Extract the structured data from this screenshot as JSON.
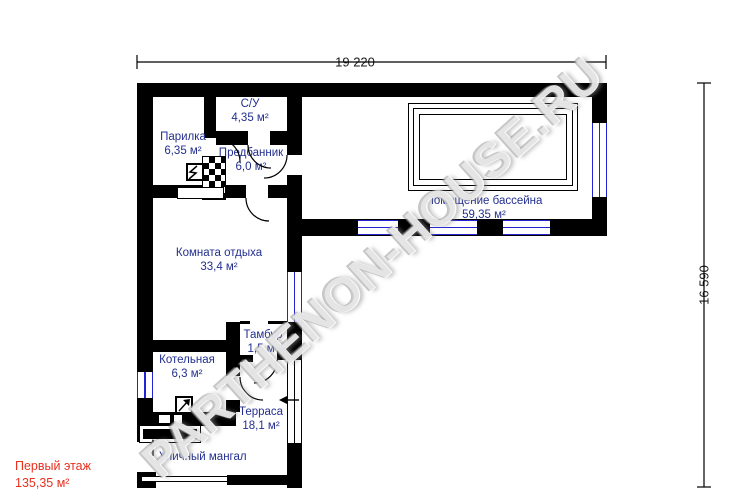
{
  "watermark": "PARTHENON-HOUSE.RU",
  "dimensions": {
    "width": "19 220",
    "height": "16 590"
  },
  "rooms": {
    "parilka": {
      "name": "Парилка",
      "area": "6,35 м²"
    },
    "su": {
      "name": "С/У",
      "area": "4,35 м²"
    },
    "predbannik": {
      "name": "Предбанник",
      "area": "6,0 м²"
    },
    "otdyh": {
      "name": "Комната отдыха",
      "area": "33,4 м²"
    },
    "bassein": {
      "name": "Помещение бассейна",
      "area": "59,35 м²"
    },
    "tambur": {
      "name": "Тамбур",
      "area": "1,5 м²"
    },
    "kotelnaya": {
      "name": "Котельная",
      "area": "6,3 м²"
    },
    "terrasa": {
      "name": "Терраса",
      "area": "18,1 м²"
    }
  },
  "labels": {
    "grill": "Уличный мангал"
  },
  "floor": {
    "title": "Первый этаж",
    "area": "135,35 м²"
  },
  "colors": {
    "wall": "#000000",
    "room-label": "#232f8f",
    "window": "#2323d6",
    "floor-label": "#e6311f",
    "dim": "#1a1a1a"
  }
}
